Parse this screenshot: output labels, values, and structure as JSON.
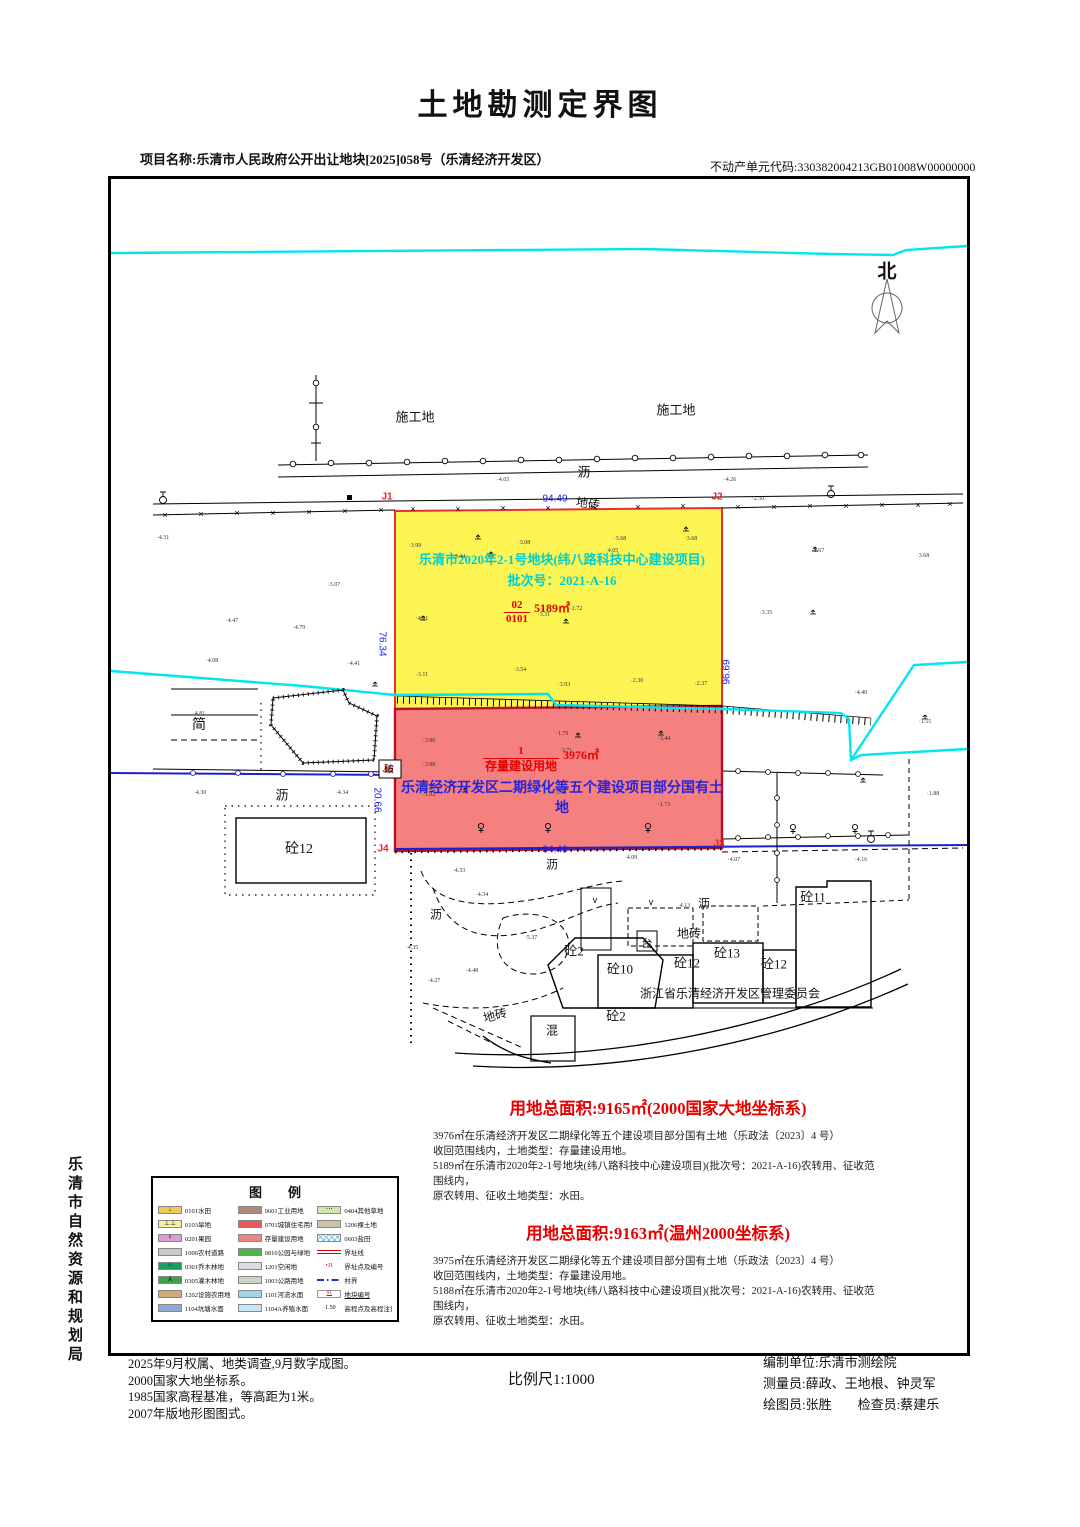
{
  "title": "土地勘测定界图",
  "header": {
    "project_label": "项目名称:乐清市人民政府公开出让地块[2025]058号（乐清经济开发区）",
    "unit_code": "不动产单元代码:330382004213GB01008W00000000"
  },
  "side_label": "乐清市自然资源和规划局",
  "map": {
    "north_label": "北",
    "parcels": {
      "yellow": {
        "name_line1": "乐清市2020年2-1号地块(纬八路科技中心建设项目)",
        "name_line2": "批次号：2021-A-16",
        "code_top": "02",
        "code_bottom": "0101",
        "area": "5189㎡",
        "fill": "#fcf452",
        "corner_tl": "J1",
        "corner_tr": "J2",
        "edge_top": "94.49",
        "edge_left": "76.34",
        "edge_right": "96.69"
      },
      "red": {
        "code_top": "1",
        "code_bottom": "存量建设用地",
        "area": "3976㎡",
        "owner_text": "乐清经济开发区二期绿化等五个建设项目部分国有土地",
        "fill": "#f58080",
        "corner_l": "J5",
        "corner_bl": "J4",
        "corner_br": "J3",
        "edge_bottom": "94.49",
        "edge_left": "20.66"
      }
    },
    "labels": [
      {
        "x": 412,
        "y": 413,
        "t": "施工地",
        "s": 13
      },
      {
        "x": 673,
        "y": 406,
        "t": "施工地",
        "s": 13
      },
      {
        "x": 581,
        "y": 468,
        "t": "沥",
        "s": 13
      },
      {
        "x": 585,
        "y": 500,
        "t": "地砖",
        "s": 12,
        "r": 8
      },
      {
        "x": 196,
        "y": 721,
        "t": "简",
        "s": 14
      },
      {
        "x": 279,
        "y": 791,
        "t": "沥",
        "s": 13
      },
      {
        "x": 296,
        "y": 845,
        "t": "砼12",
        "s": 14
      },
      {
        "x": 386,
        "y": 765,
        "t": "破",
        "s": 10
      },
      {
        "x": 549,
        "y": 861,
        "t": "沥",
        "s": 12
      },
      {
        "x": 433,
        "y": 911,
        "t": "沥",
        "s": 12
      },
      {
        "x": 701,
        "y": 900,
        "t": "沥",
        "s": 12
      },
      {
        "x": 686,
        "y": 930,
        "t": "地砖",
        "s": 12
      },
      {
        "x": 644,
        "y": 940,
        "t": "台",
        "s": 11
      },
      {
        "x": 571,
        "y": 947,
        "t": "砼2",
        "s": 13
      },
      {
        "x": 617,
        "y": 965,
        "t": "砼10",
        "s": 13
      },
      {
        "x": 684,
        "y": 959,
        "t": "砼12",
        "s": 13
      },
      {
        "x": 724,
        "y": 949,
        "t": "砼13",
        "s": 13
      },
      {
        "x": 771,
        "y": 960,
        "t": "砼12",
        "s": 13
      },
      {
        "x": 810,
        "y": 893,
        "t": "砼11",
        "s": 13
      },
      {
        "x": 727,
        "y": 990,
        "t": "浙江省乐清经济开发区管理委员会",
        "s": 12
      },
      {
        "x": 613,
        "y": 1012,
        "t": "砼2",
        "s": 13
      },
      {
        "x": 549,
        "y": 1027,
        "t": "混",
        "s": 12
      },
      {
        "x": 492,
        "y": 1012,
        "t": "地砖",
        "s": 12,
        "r": -15
      }
    ],
    "spot_heights": [
      {
        "x": 500,
        "y": 477,
        "v": "4.65"
      },
      {
        "x": 727,
        "y": 477,
        "v": "4.26"
      },
      {
        "x": 755,
        "y": 496,
        "v": "2.50"
      },
      {
        "x": 160,
        "y": 535,
        "v": "4.31"
      },
      {
        "x": 412,
        "y": 543,
        "v": "3.99"
      },
      {
        "x": 521,
        "y": 540,
        "v": "3.08"
      },
      {
        "x": 617,
        "y": 536,
        "v": "3.68"
      },
      {
        "x": 688,
        "y": 536,
        "v": "3.68"
      },
      {
        "x": 456,
        "y": 554,
        "v": "3.44"
      },
      {
        "x": 609,
        "y": 548,
        "v": "4.05"
      },
      {
        "x": 815,
        "y": 548,
        "v": "3.67"
      },
      {
        "x": 920,
        "y": 553,
        "v": "3.68"
      },
      {
        "x": 331,
        "y": 582,
        "v": "3.07"
      },
      {
        "x": 229,
        "y": 618,
        "v": "4.47"
      },
      {
        "x": 296,
        "y": 625,
        "v": "4.79"
      },
      {
        "x": 419,
        "y": 616,
        "v": "4.31"
      },
      {
        "x": 541,
        "y": 612,
        "v": "3.31"
      },
      {
        "x": 573,
        "y": 606,
        "v": "2.72"
      },
      {
        "x": 763,
        "y": 610,
        "v": "3.35"
      },
      {
        "x": 209,
        "y": 658,
        "v": "4.08"
      },
      {
        "x": 351,
        "y": 661,
        "v": "4.41"
      },
      {
        "x": 419,
        "y": 672,
        "v": "3.11"
      },
      {
        "x": 517,
        "y": 667,
        "v": "3.54"
      },
      {
        "x": 634,
        "y": 678,
        "v": "2.30"
      },
      {
        "x": 698,
        "y": 681,
        "v": "2.37"
      },
      {
        "x": 858,
        "y": 690,
        "v": "4.40"
      },
      {
        "x": 561,
        "y": 682,
        "v": "3.93"
      },
      {
        "x": 196,
        "y": 711,
        "v": "4.81"
      },
      {
        "x": 426,
        "y": 738,
        "v": "3.90"
      },
      {
        "x": 559,
        "y": 731,
        "v": "1.79"
      },
      {
        "x": 661,
        "y": 736,
        "v": "3.44"
      },
      {
        "x": 922,
        "y": 719,
        "v": "1.55"
      },
      {
        "x": 426,
        "y": 762,
        "v": "3.98"
      },
      {
        "x": 563,
        "y": 748,
        "v": "3.71"
      },
      {
        "x": 426,
        "y": 792,
        "v": "1.92"
      },
      {
        "x": 557,
        "y": 790,
        "v": "3.78"
      },
      {
        "x": 661,
        "y": 802,
        "v": "1.73"
      },
      {
        "x": 930,
        "y": 791,
        "v": "1.88"
      },
      {
        "x": 197,
        "y": 790,
        "v": "4.30"
      },
      {
        "x": 339,
        "y": 790,
        "v": "4.34"
      },
      {
        "x": 628,
        "y": 855,
        "v": "4.09"
      },
      {
        "x": 731,
        "y": 857,
        "v": "4.07"
      },
      {
        "x": 858,
        "y": 857,
        "v": "4.16"
      },
      {
        "x": 456,
        "y": 868,
        "v": "4.33"
      },
      {
        "x": 479,
        "y": 892,
        "v": "4.34"
      },
      {
        "x": 409,
        "y": 945,
        "v": "4.35"
      },
      {
        "x": 469,
        "y": 968,
        "v": "4.48"
      },
      {
        "x": 431,
        "y": 978,
        "v": "4.27"
      },
      {
        "x": 528,
        "y": 935,
        "v": "5.37"
      },
      {
        "x": 681,
        "y": 903,
        "v": "4.13"
      }
    ]
  },
  "areas": {
    "heading1": "用地总面积:9165㎡(2000国家大地坐标系)",
    "para1": [
      "3976㎡在乐清经济开发区二期绿化等五个建设项目部分国有土地（乐政法〔2023〕4 号）",
      "收回范围线内，土地类型：存量建设用地。",
      "5189㎡在乐清市2020年2-1号地块(纬八路科技中心建设项目)(批次号：2021-A-16)农转用、征收范围线内，",
      "原农转用、征收土地类型：水田。"
    ],
    "heading2": "用地总面积:9163㎡(温州2000坐标系)",
    "para2": [
      "3975㎡在乐清经济开发区二期绿化等五个建设项目部分国有土地（乐政法〔2023〕4 号）",
      "收回范围线内，土地类型：存量建设用地。",
      "5188㎡在乐清市2020年2-1号地块(纬八路科技中心建设项目)(批次号：2021-A-16)农转用、征收范围线内，",
      "原农转用、征收土地类型：水田。"
    ]
  },
  "legend": {
    "title": "图　　例",
    "columns": [
      [
        {
          "label": "0101水田",
          "color": "#f0c75e",
          "icon": "↓"
        },
        {
          "label": "0103旱地",
          "color": "#f7f0a2",
          "icon": "⊥⊥"
        },
        {
          "label": "0201果园",
          "color": "#d79fd3",
          "icon": "♀"
        },
        {
          "label": "1006农村道路",
          "color": "#c9c9c9",
          "icon": ""
        },
        {
          "label": "0301乔木林地",
          "color": "#18a060",
          "icon": "○"
        },
        {
          "label": "0305灌木林地",
          "color": "#3aa251",
          "icon": "⅄"
        },
        {
          "label": "1202设施农用地",
          "color": "#d4a874",
          "icon": ""
        },
        {
          "label": "1104坑塘水面",
          "color": "#8fa8d6",
          "icon": ""
        }
      ],
      [
        {
          "label": "0601工业用地",
          "color": "#b18a7f"
        },
        {
          "label": "0701城镇住宅用地",
          "color": "#e55c5c"
        },
        {
          "label": "存量建设用地",
          "color": "#ee8585"
        },
        {
          "label": "0810公园与绿地",
          "color": "#52b148"
        },
        {
          "label": "1201空闲地",
          "color": "#dedbe7"
        },
        {
          "label": "1003公路用地",
          "color": "#ccd5c5"
        },
        {
          "label": "1101河流水面",
          "color": "#a6d1ea"
        },
        {
          "label": "1104A养殖水面",
          "color": "#c6e6f4"
        }
      ],
      [
        {
          "label": "0404其他草地",
          "color": "#cfe9ad",
          "icon": "⋯"
        },
        {
          "label": "1206裸土地",
          "color": "#cec1a6"
        },
        {
          "label": "0603盐田"
        },
        {
          "label": "界址线"
        },
        {
          "label": "界址点及编号",
          "icon": "•J1"
        },
        {
          "label": "村界"
        },
        {
          "label": "地块编号",
          "icon": "01"
        },
        {
          "label": "高程点及高程注记",
          "icon": "·1.50"
        }
      ]
    ]
  },
  "footer": {
    "notes": [
      "2025年9月权属、地类调查,9月数字成图。",
      "2000国家大地坐标系。",
      "1985国家高程基准，等高距为1米。",
      "2007年版地形图图式。"
    ],
    "scale": "比例尺1:1000",
    "credits": [
      "编制单位:乐清市测绘院",
      "测量员:薛政、王地根、钟灵军",
      "绘图员:张胜　　检查员:蔡建乐"
    ]
  }
}
